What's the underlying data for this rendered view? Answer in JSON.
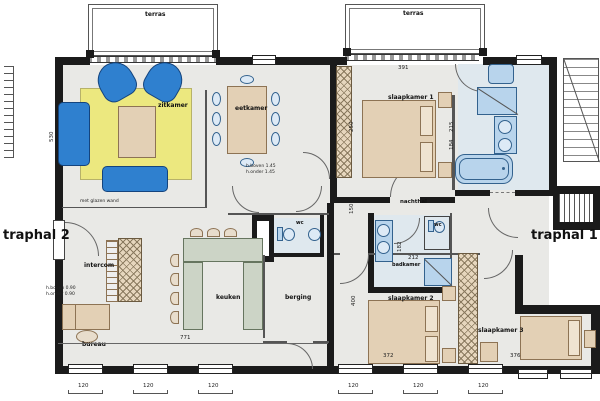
{
  "plan_title": "apartment floor plan",
  "labels": {
    "terras_left": "terras",
    "terras_right": "terras",
    "zitkamer": "zitkamer",
    "eetkamer": "eetkamer",
    "slaapkamer1": "slaapkamer 1",
    "slaapkamer2": "slaapkamer 2",
    "slaapkamer3": "slaapkamer 3",
    "nachthal": "nachthal",
    "badkamer": "badkamer",
    "wc_mid": "wc",
    "wc_bad": "wc",
    "keuken": "keuken",
    "berging": "berging",
    "intercom": "intercom",
    "bureau": "bureau",
    "traphal1": "traphal 1",
    "traphal2": "traphal 2",
    "glass_wall_note": "met glazen wand",
    "note_top_1": "h.boven 1.45",
    "note_top_2": "h.onder 1.45",
    "note_left_1": "h.boven 0.90",
    "note_left_2": "h.onder 0.90"
  },
  "dimensions": {
    "win_l": [
      "120",
      "120",
      "120"
    ],
    "win_r": [
      "120",
      "120",
      "120"
    ],
    "total_left": "771",
    "sk1_width": "391",
    "sk2_width": "372",
    "sk3_width": "376",
    "v_250": "250",
    "v_150": "150",
    "v_400": "400",
    "v_530": "530",
    "bad_212": "212",
    "bad_182": "182",
    "bath_215": "215",
    "bath_184": "184"
  },
  "colors": {
    "wall": "#1b1b1b",
    "floor": "#e9e9e6",
    "bath_floor": "#dfe8ee",
    "rug": "#ece87f",
    "sofa_blue": "#2f80cf",
    "fixture_blue": "#b8d4ec",
    "wood": "#e3d0b5",
    "counter": "#ccd4c6"
  }
}
